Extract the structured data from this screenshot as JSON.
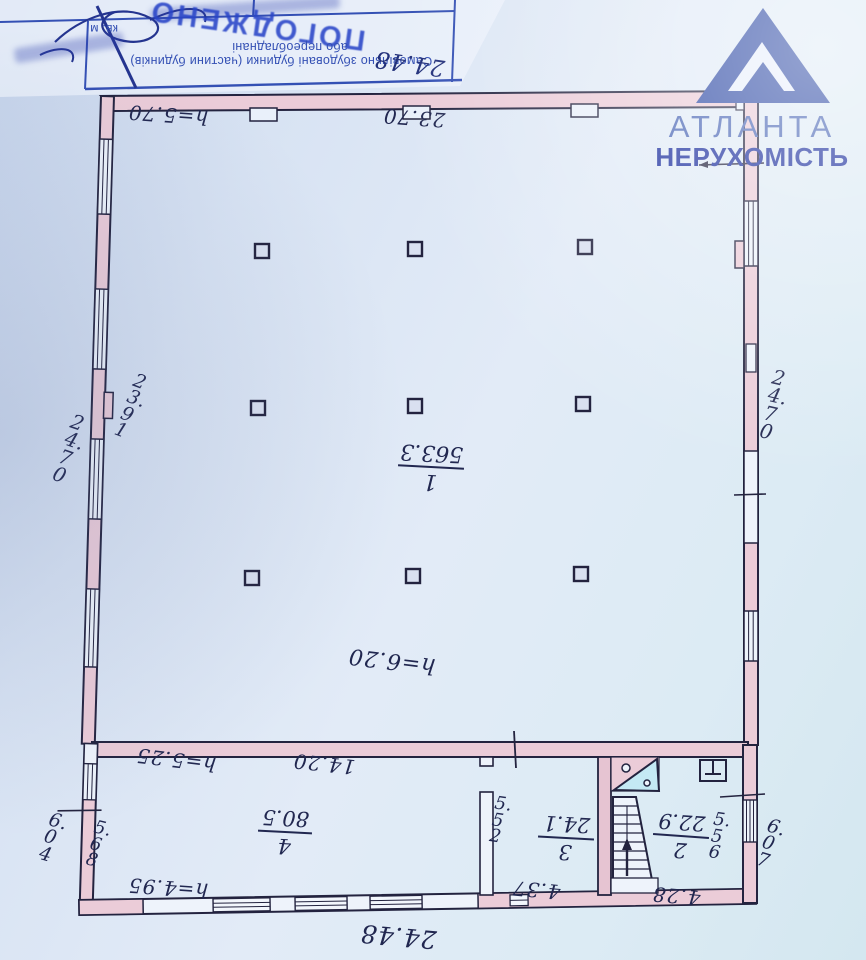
{
  "watermark": {
    "line1": "АТЛАНТА",
    "line2": "НЕРУХОМІСТЬ",
    "brand_color": "#2e4aa5"
  },
  "stamp": {
    "big": "ПОГОДЖЕНО",
    "form_line1": "Самовільно збудовані будинки (частини будинків)",
    "form_line2": "або переобладнані",
    "unit": "кв. м"
  },
  "rooms": {
    "r1": {
      "number": "1",
      "area": "563.3"
    },
    "r2": {
      "number": "2",
      "area": "22.9"
    },
    "r3": {
      "number": "3",
      "area": "24.1"
    },
    "r4": {
      "number": "4",
      "area": "80.5"
    }
  },
  "dims": {
    "top_outer": "24.48",
    "top_inner": "23.70",
    "top_height": "h=5.70",
    "left_inner": "23.91",
    "left_outer": "24.70",
    "right_outer": "24.70",
    "hall_height": "h=6.20",
    "r4_width": "14.20",
    "r4_height": "h=5.25",
    "r4_height2": "h=4.95",
    "r4_depth": "5.68",
    "left_lower": "6.04",
    "r3_depth": "5.52",
    "r3_width": "4.37",
    "r2_depth": "5.56",
    "r2_width": "4.28",
    "right_lower": "6.07",
    "bottom_outer": "24.48"
  },
  "colors": {
    "wall_fill": "#ebccd8",
    "ink": "#23233f",
    "stair_triangle": "#c4e9f4"
  }
}
